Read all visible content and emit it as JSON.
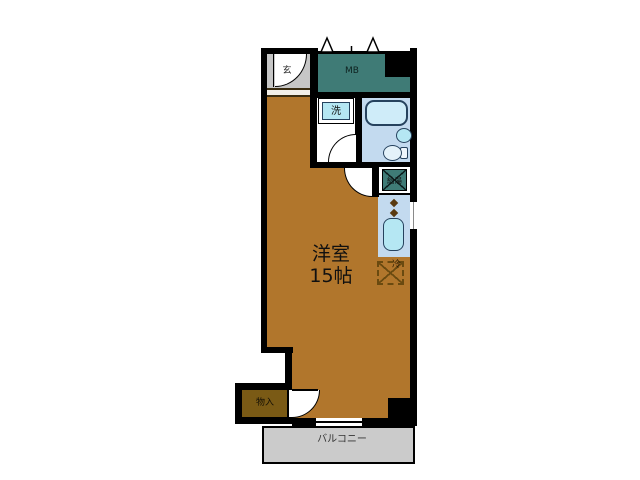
{
  "floor_plan": {
    "main_room": {
      "name": "洋室",
      "size": "15帖"
    },
    "entrance_label": "玄",
    "meter_box_label": "MB",
    "washer_label": "洗",
    "water_heater_label": "給湯",
    "fridge_label": "冷",
    "storage_label": "物入",
    "balcony_label": "バルコニー",
    "colors": {
      "wall": "#000000",
      "floor": "#b1762c",
      "storage_floor": "#7a5a15",
      "teal": "#3f7b76",
      "wet_blue": "#c3daef",
      "fixture_cyan": "#b5e7f3",
      "tub_blue": "#cfecf9",
      "entrance_gray": "#c6c6c6",
      "balcony_gray": "#cbcbcb",
      "burner_brown": "#5a3a10",
      "dash_brown": "#6a4a10",
      "fixture_line": "#26425e"
    }
  }
}
